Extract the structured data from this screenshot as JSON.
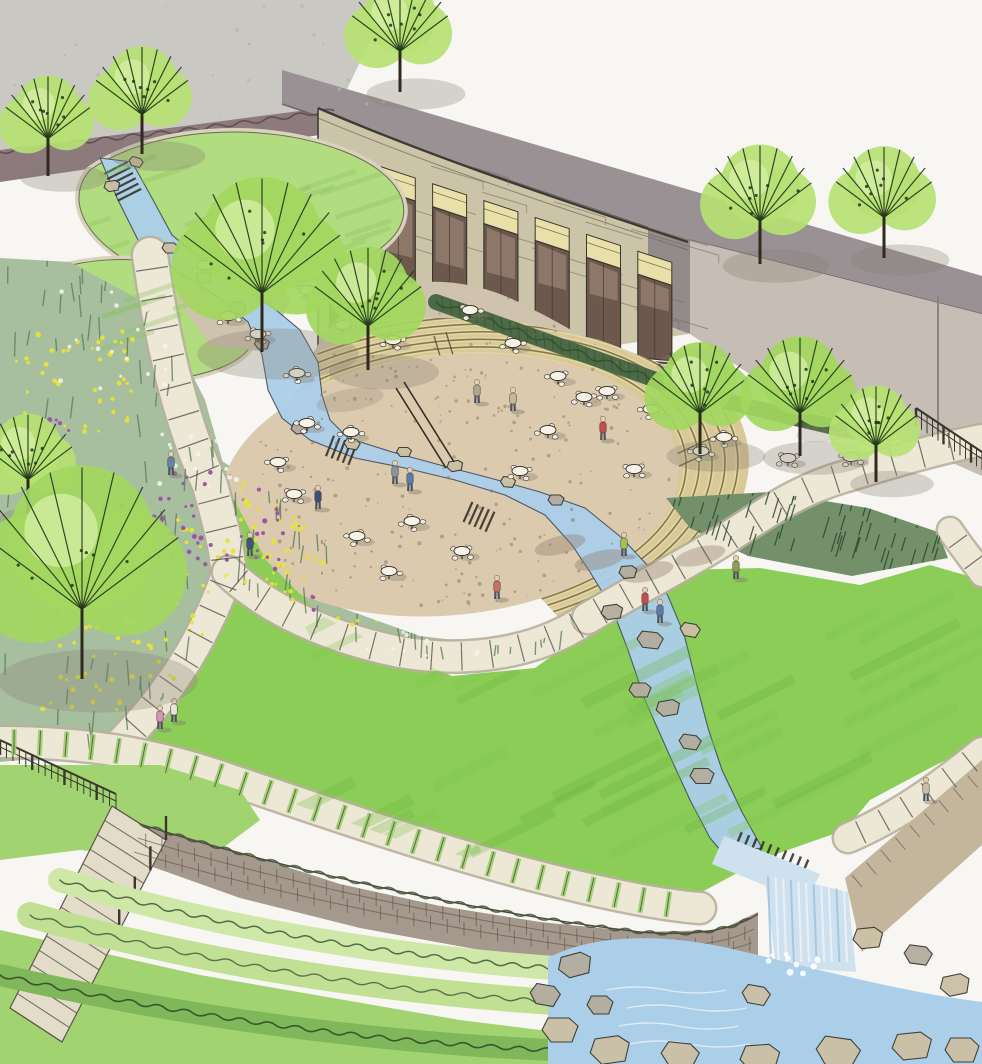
{
  "scene": {
    "description": "Hand-drawn architectural marker rendering of a landscape design: a curved stone building with tall windows overlooks an elliptical amphitheater plaza with cafe tables; a stream winds from the upper lawns through the plaza, across a large oval lawn and over a stone retaining wall as a waterfall into a boulder pool; flower meadows, curving walkways, stairs, fences and trees complete the garden.",
    "style": "landscape architecture concept sketch, ink and marker",
    "visible_text": "none"
  },
  "palette": {
    "paper": "#f7f6f3",
    "concreteWall": "#cac8c3",
    "wallSpeckle": "#b2afa9",
    "parapet": "#9a9194",
    "rightWall": "#c6bdb4",
    "returnWall": "#938a8c",
    "stone": "#ccc4a9",
    "masonry": "#6f6852",
    "windowHeader": "#e9e0a9",
    "windowGlass": "#6d584e",
    "windowGlassLight": "#9b8474",
    "hedgeMauve": "#8c7a7d",
    "hedgeMauveDark": "#564549",
    "hedgeDark": "#4d6a46",
    "hedgeDarkLine": "#33512f",
    "treeGreen": "#b6e173",
    "treeGreen2": "#a3d75f",
    "treeHighlight": "#d7efa6",
    "branch": "#22351b",
    "lawnUL": "#b2dc80",
    "lawnEdge": "#d9d2bc",
    "meadow": "#a7bf9f",
    "meadowStroke": "#5f7f58",
    "flowerYellow": "#e7e335",
    "flowerPurple": "#9a51a3",
    "flowerWhite": "#f3f5ef",
    "plaza": "#dbcaae",
    "terrace": "#cfc3ae",
    "speckle": "#84755a",
    "seatBand": "#d8c996",
    "seatLine": "#7c6f3e",
    "seatLight": "#e3d6a8",
    "path": "#ede8d6",
    "pathEdge": "#b7b09c",
    "pathJoint": "#4c4a42",
    "water": "#abcfe9",
    "waterLight": "#cfe1ef",
    "waterDeep": "#6f93b5",
    "foam": "#ffffff",
    "brick": "#a5988c",
    "brickLine": "#5a5048",
    "brick2": "#c4b69c",
    "shrub1": "#cfe8a8",
    "shrub2": "#c2e094",
    "shrubDark": "#7fb75a",
    "squiggle": "#3e5534",
    "bigLawn": "#8ccd58",
    "lawnStroke": "#68b33c",
    "bottomLawn": "#a2d371",
    "rock": "#ccc0a5",
    "rockGray": "#b4ada0",
    "rockEdge": "#3a3a32",
    "shadow": "#867e70",
    "ink": "#3a372e",
    "skin": "#e6cfae",
    "pants": "#4c5160"
  },
  "building": {
    "windowCount": 7
  },
  "seating": {
    "rows": 6
  },
  "trees": [
    {
      "x": 48,
      "y": 118,
      "r": 46,
      "tone": "a"
    },
    {
      "x": 142,
      "y": 92,
      "r": 50,
      "tone": "a"
    },
    {
      "x": 400,
      "y": 28,
      "r": 52,
      "tone": "a"
    },
    {
      "x": 262,
      "y": 255,
      "r": 85,
      "tone": "b"
    },
    {
      "x": 368,
      "y": 300,
      "r": 58,
      "tone": "b"
    },
    {
      "x": 28,
      "y": 458,
      "r": 48,
      "tone": "a"
    },
    {
      "x": 82,
      "y": 562,
      "r": 105,
      "tone": "b"
    },
    {
      "x": 760,
      "y": 196,
      "r": 56,
      "tone": "a"
    },
    {
      "x": 884,
      "y": 194,
      "r": 52,
      "tone": "a"
    },
    {
      "x": 700,
      "y": 390,
      "r": 52,
      "tone": "b"
    },
    {
      "x": 800,
      "y": 388,
      "r": 56,
      "tone": "b"
    },
    {
      "x": 876,
      "y": 426,
      "r": 44,
      "tone": "a"
    }
  ],
  "tables": [
    [
      205,
      265
    ],
    [
      243,
      272
    ],
    [
      228,
      316
    ],
    [
      258,
      334
    ],
    [
      297,
      373
    ],
    [
      307,
      290
    ],
    [
      343,
      325
    ],
    [
      393,
      340
    ],
    [
      470,
      310
    ],
    [
      513,
      343
    ],
    [
      307,
      423
    ],
    [
      278,
      462
    ],
    [
      294,
      494
    ],
    [
      351,
      432
    ],
    [
      357,
      536
    ],
    [
      412,
      521
    ],
    [
      389,
      571
    ],
    [
      462,
      551
    ],
    [
      520,
      471
    ],
    [
      548,
      430
    ],
    [
      584,
      397
    ],
    [
      634,
      469
    ],
    [
      701,
      451
    ],
    [
      558,
      376
    ],
    [
      607,
      391
    ],
    [
      651,
      409
    ],
    [
      724,
      437
    ],
    [
      788,
      458
    ],
    [
      851,
      457
    ]
  ],
  "people": [
    {
      "x": 603,
      "y": 428,
      "c": "#c0504d"
    },
    {
      "x": 513,
      "y": 399,
      "c": "#c8b89a"
    },
    {
      "x": 395,
      "y": 472,
      "c": "#8a93a6"
    },
    {
      "x": 410,
      "y": 479,
      "c": "#5d7aa8"
    },
    {
      "x": 318,
      "y": 497,
      "c": "#3d4f7d"
    },
    {
      "x": 250,
      "y": 544,
      "c": "#45507e"
    },
    {
      "x": 624,
      "y": 544,
      "c": "#a9c04f"
    },
    {
      "x": 645,
      "y": 599,
      "c": "#c0504d"
    },
    {
      "x": 660,
      "y": 611,
      "c": "#5d7aa8"
    },
    {
      "x": 497,
      "y": 587,
      "c": "#c4706b"
    },
    {
      "x": 160,
      "y": 717,
      "c": "#d795b5"
    },
    {
      "x": 174,
      "y": 710,
      "c": "#e8e4da"
    },
    {
      "x": 171,
      "y": 463,
      "c": "#6b82a8"
    },
    {
      "x": 926,
      "y": 789,
      "c": "#c8bfa8"
    },
    {
      "x": 477,
      "y": 391,
      "c": "#b0a88e"
    },
    {
      "x": 736,
      "y": 567,
      "c": "#8aa04a"
    }
  ],
  "rocks": {
    "stream": [
      [
        112,
        186,
        16,
        10,
        -10
      ],
      [
        136,
        162,
        14,
        9,
        15
      ],
      [
        170,
        248,
        16,
        10,
        0
      ],
      [
        204,
        278,
        15,
        10,
        -12
      ],
      [
        238,
        308,
        16,
        11,
        8
      ],
      [
        262,
        344,
        15,
        10,
        0
      ],
      [
        300,
        428,
        18,
        11,
        -8
      ],
      [
        352,
        444,
        16,
        10,
        10
      ],
      [
        404,
        452,
        15,
        9,
        0
      ],
      [
        455,
        466,
        16,
        10,
        -10
      ],
      [
        508,
        482,
        15,
        10,
        5
      ],
      [
        556,
        500,
        16,
        10,
        0
      ],
      [
        612,
        612,
        22,
        14,
        -8
      ],
      [
        650,
        640,
        26,
        16,
        6
      ],
      [
        640,
        690,
        22,
        14,
        0
      ],
      [
        668,
        708,
        24,
        15,
        -10
      ],
      [
        690,
        742,
        22,
        14,
        8
      ],
      [
        702,
        776,
        24,
        15,
        0
      ],
      [
        628,
        572,
        18,
        12,
        -5
      ],
      [
        690,
        630,
        20,
        13,
        10
      ]
    ],
    "pool": [
      [
        575,
        965,
        34,
        22,
        -15
      ],
      [
        545,
        995,
        30,
        20,
        10
      ],
      [
        560,
        1030,
        36,
        24,
        0
      ],
      [
        610,
        1050,
        40,
        26,
        -8
      ],
      [
        680,
        1055,
        38,
        24,
        6
      ],
      [
        760,
        1058,
        40,
        26,
        -4
      ],
      [
        838,
        1052,
        44,
        28,
        8
      ],
      [
        912,
        1046,
        40,
        26,
        -6
      ],
      [
        962,
        1050,
        34,
        24,
        0
      ],
      [
        955,
        985,
        30,
        20,
        -12
      ],
      [
        918,
        955,
        28,
        18,
        8
      ],
      [
        868,
        938,
        30,
        20,
        -6
      ],
      [
        600,
        1005,
        26,
        18,
        0
      ],
      [
        756,
        995,
        28,
        18,
        10
      ]
    ]
  },
  "flowers": {
    "yellow": [
      [
        15,
        330,
        120,
        110,
        45
      ],
      [
        40,
        600,
        190,
        110,
        55
      ],
      [
        175,
        520,
        200,
        80,
        60
      ],
      [
        330,
        565,
        200,
        70,
        55
      ],
      [
        455,
        575,
        110,
        55,
        30
      ],
      [
        240,
        470,
        90,
        60,
        25
      ]
    ],
    "purple": [
      [
        140,
        470,
        150,
        100,
        50
      ],
      [
        300,
        555,
        150,
        55,
        35
      ],
      [
        0,
        415,
        70,
        50,
        18
      ],
      [
        55,
        505,
        70,
        60,
        20
      ]
    ],
    "white": [
      [
        60,
        280,
        130,
        110,
        25
      ],
      [
        330,
        610,
        160,
        50,
        18
      ],
      [
        150,
        430,
        90,
        60,
        15
      ]
    ]
  },
  "meadowStrokeZones": [
    [
      0,
      255,
      160,
      190
    ],
    [
      0,
      430,
      200,
      330
    ],
    [
      140,
      380,
      140,
      220
    ],
    [
      230,
      460,
      200,
      170
    ],
    [
      350,
      540,
      220,
      120
    ],
    [
      60,
      680,
      260,
      80
    ],
    [
      430,
      570,
      130,
      90
    ],
    [
      230,
      540,
      180,
      90
    ],
    [
      380,
      600,
      180,
      60
    ]
  ]
}
